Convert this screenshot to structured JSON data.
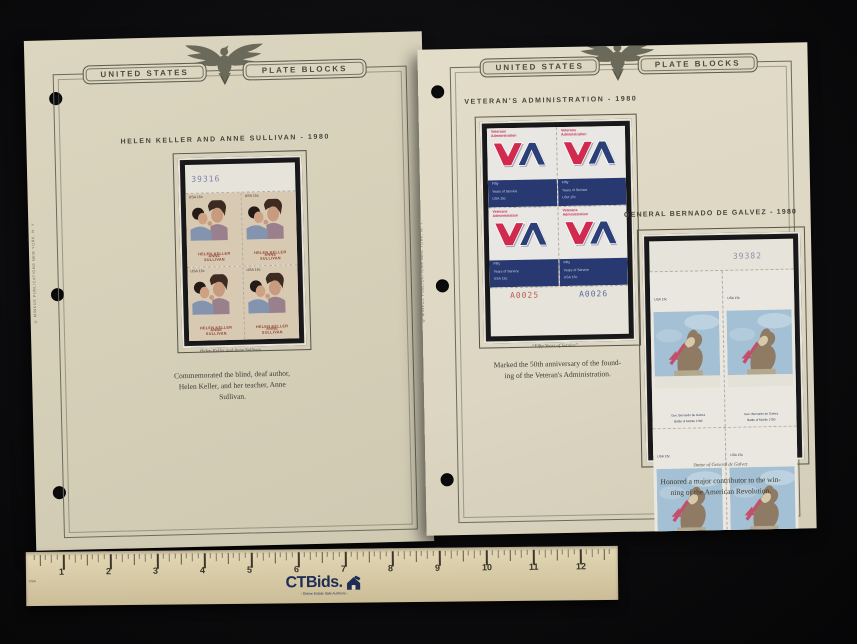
{
  "pages": {
    "header_left": "UNITED STATES",
    "header_right": "PLATE BLOCKS",
    "publisher": "© MINKUS PUBLICATIONS NEW YORK, N. Y."
  },
  "left_page": {
    "title": "HELEN KELLER AND ANNE SULLIVAN - 1980",
    "plate_number": "39316",
    "stamp": {
      "denom": "USA 15c",
      "name1": "HELEN KELLER",
      "name2": "ANNE SULLIVAN"
    },
    "caption": "Helen Keller and Anne Sullivan",
    "description": {
      "line1": "Commemorated the blind, deaf author,",
      "line2": "Helen Keller, and her teacher, Anne",
      "line3": "Sullivan."
    }
  },
  "right_page": {
    "va": {
      "title": "VETERAN'S ADMINISTRATION - 1980",
      "plate_left": "A0025",
      "plate_right": "A0026",
      "stamp": {
        "agency1": "Veterans",
        "agency2": "Administration",
        "panel1": "Fifty",
        "panel2": "Years of Service",
        "panel3": "USA 15c"
      },
      "caption": "“Fifty Years of Service”",
      "description": {
        "line1": "Marked the 50th anniversary of the found-",
        "line2": "ing of the Veteran's Administration."
      }
    },
    "galvez": {
      "title": "GENERAL BERNADO DE GALVEZ - 1980",
      "plate_number": "39382",
      "stamp": {
        "denom": "USA 15c",
        "cap1": "Gen. Bernardo de Galvez",
        "cap2": "Battle of Mobile 1780"
      },
      "caption": "Statue of General de Galvez",
      "description": {
        "line1": "Honored a major contributor to the win-",
        "line2": "ning of the American Revolution."
      }
    }
  },
  "ruler": {
    "brand": "CTBids.",
    "tagline": "- Online Estate Sale Auctions -",
    "numbers": [
      "1",
      "2",
      "3",
      "4",
      "5",
      "6",
      "7",
      "8",
      "9",
      "10",
      "11",
      "12"
    ],
    "origin_label": "USA"
  },
  "colors": {
    "va_red": "#c52e4e",
    "va_blue": "#273970",
    "page_cream": "#dcd6c0",
    "mount_black": "#151517"
  }
}
